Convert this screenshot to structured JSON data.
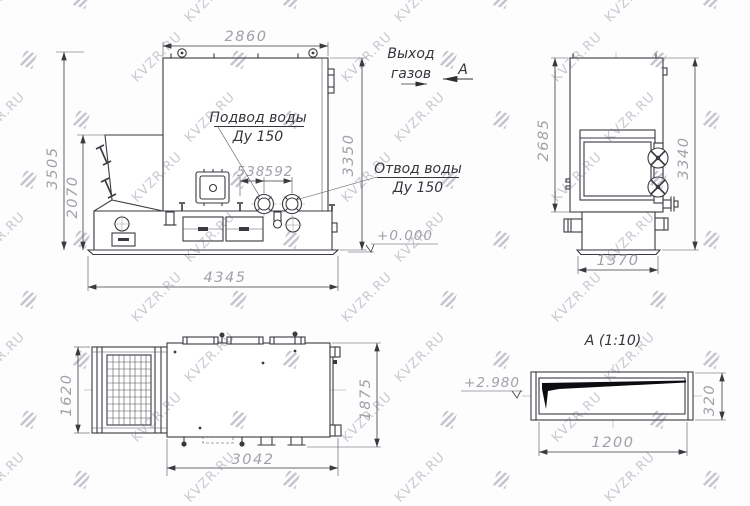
{
  "watermark": {
    "text": "KVZR.RU"
  },
  "colors": {
    "line": "#3a3a40",
    "dim_text": "#a0a0a8",
    "label_text": "#35353b",
    "watermark": "#c9c9d2",
    "background": "#fdfdfe"
  },
  "side_view": {
    "dim_top_width": "2860",
    "dim_height_total": "3505",
    "dim_hopper_height": "2070",
    "dim_height_right": "3350",
    "dim_base_length": "4345",
    "dim_nozzle_inlet": "538",
    "dim_nozzle_outlet": "592",
    "label_inlet_line1": "Подвод воды",
    "label_inlet_line2": "Ду 150",
    "label_outlet_line1": "Отвод воды",
    "label_outlet_line2": "Ду 150",
    "label_gas_line1": "Выход",
    "label_gas_line2": "газов",
    "section_arrow_label": "А",
    "level_mark": "+0.000"
  },
  "front_view": {
    "dim_body_height": "2685",
    "dim_total_height": "3340",
    "dim_width": "1370"
  },
  "plan_view": {
    "dim_grate_width": "1620",
    "dim_body_width": "1875",
    "dim_length": "3042"
  },
  "section_view": {
    "title": "А (1:10)",
    "level_mark": "+2.980",
    "dim_height": "320",
    "dim_width": "1200"
  }
}
